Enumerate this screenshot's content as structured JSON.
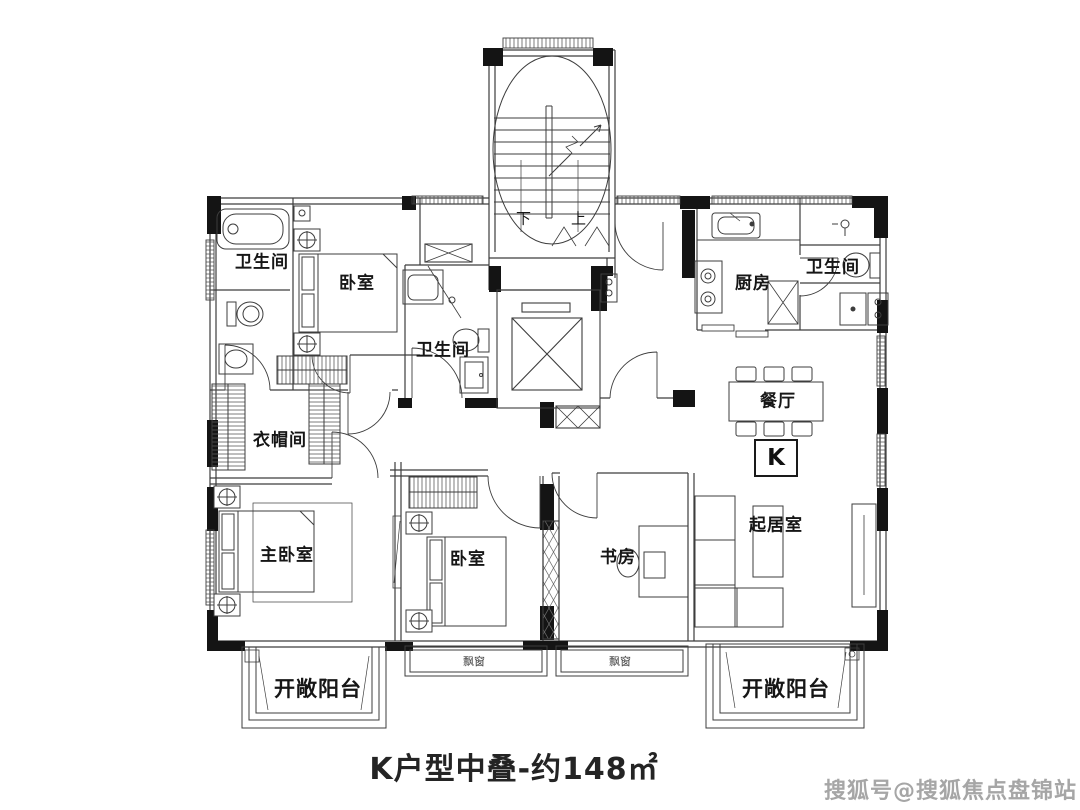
{
  "title": "K户型中叠-约148㎡",
  "watermark": "搜狐号@搜狐焦点盘锦站",
  "unit_badge": "K",
  "stair_labels": {
    "down": "下",
    "up": "上"
  },
  "room_labels": {
    "bath_top_left": "卫生间",
    "bedroom_top": "卧室",
    "bath_center": "卫生间",
    "kitchen": "厨房",
    "bath_top_right": "卫生间",
    "dining_room": "餐厅",
    "cloakroom": "衣帽间",
    "master_bedroom": "主卧室",
    "bedroom_bottom": "卧室",
    "study": "书房",
    "living_room": "起居室",
    "balcony_left": "开敞阳台",
    "balcony_right": "开敞阳台",
    "bay_window_left": "飘窗",
    "bay_window_right": "飘窗"
  },
  "colors": {
    "linework": "#3d3d3d",
    "structural_wall": "#141414",
    "watermark_gray": "#a6a6a6"
  }
}
